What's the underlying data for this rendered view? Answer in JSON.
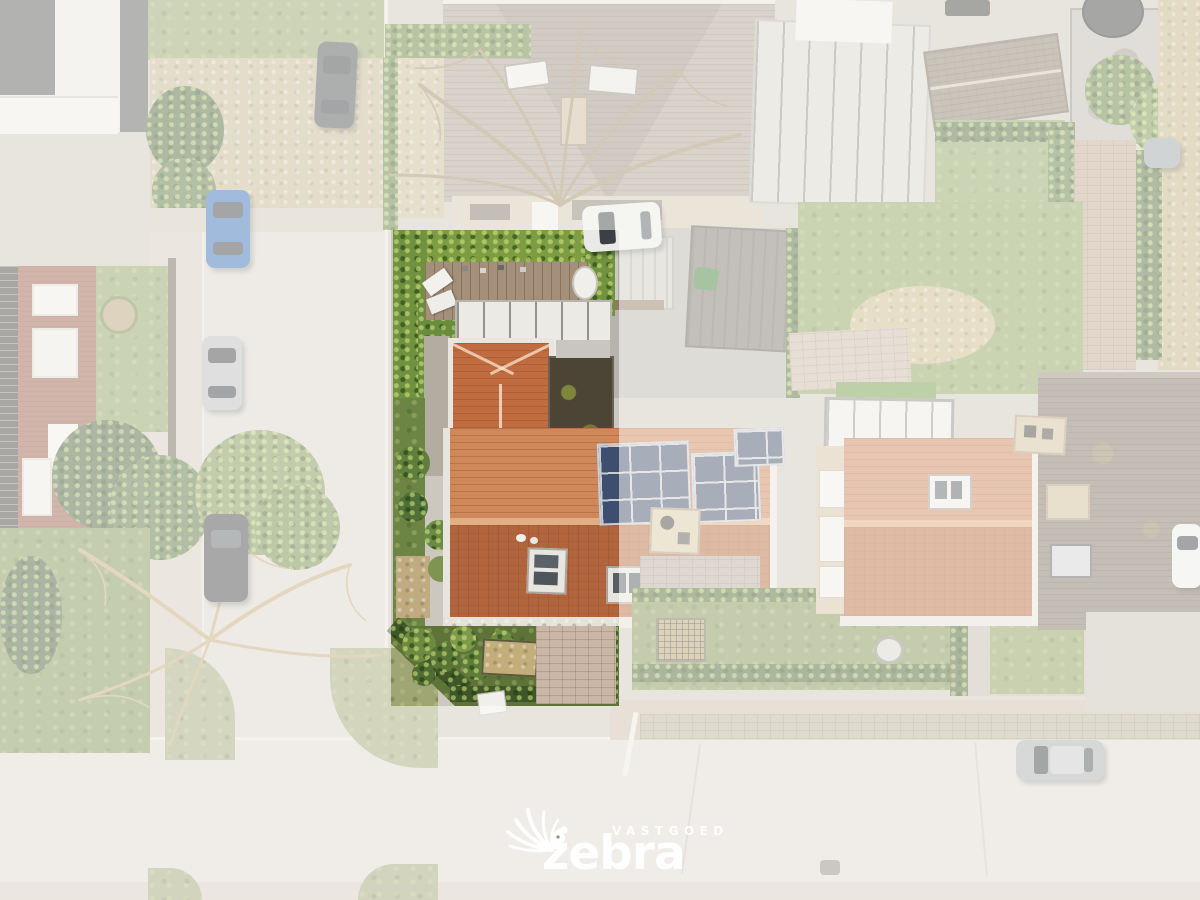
{
  "image_type": "aerial-drone-photo-real-estate",
  "watermark": {
    "tagline": "VASTGOED",
    "brand": "zebra"
  },
  "palette": {
    "base": "#ccc8bf",
    "road": "#d9d5cf",
    "road2": "#dedad4",
    "sidewalk": "#d2cabe",
    "paver_pink": "#cdbcab",
    "paver_green": "#b5b29c",
    "grass": "#8ba15e",
    "grass_dark": "#75904a",
    "hedge": "#56712f",
    "hedge_bright": "#7d9c44",
    "gravel": "#c6b894",
    "deck": "#a4907a",
    "white_trim": "#eceae4",
    "roof_orange": "#c4734a",
    "roof_orange_light": "#d0875a",
    "roof_orange_dark": "#b2653c",
    "ridge": "#e2ae83",
    "flat_dark": "#4c4536",
    "moss": "#7c7f3e",
    "roof_gray": "#ab9f93",
    "roof_brown": "#7d7264",
    "concrete": "#bdb8b1",
    "brick_red": "#9a5c49",
    "cream": "#d6c7b2",
    "solar": "#3d4e6e",
    "overlay": "rgba(255,253,250,0.55)",
    "logo_white": "rgba(255,255,255,0.92)"
  },
  "scene": {
    "description": "Top-down aerial view of a residential block. Center: highlighted semi-detached house with orange tile roof, rear wooden deck with white pergola, hedge-bordered front garden. Surroundings faded white: neighbouring houses and gardens, vertical street on the left meeting a horizontal street at the bottom, parked cars, solar panels on the neighbour half of the roof.",
    "highlighted_property": "center parcel with orange tiled roof house",
    "cars": [
      {
        "name": "dark-car-street-top",
        "color": "#4a4e52"
      },
      {
        "name": "blue-car-street",
        "color": "#2e6cb5"
      },
      {
        "name": "silver-car-street",
        "color": "#b7babd"
      },
      {
        "name": "dark-car-street-lower",
        "color": "#3c4043"
      },
      {
        "name": "white-car-driveway",
        "color": "#e9eae8"
      },
      {
        "name": "grey-van-top-right",
        "color": "#9aa2a8"
      },
      {
        "name": "white-car-right-edge",
        "color": "#eceded"
      },
      {
        "name": "grey-car-bottom-road",
        "color": "#a7acb0"
      }
    ],
    "solar_panel_count": 14
  }
}
